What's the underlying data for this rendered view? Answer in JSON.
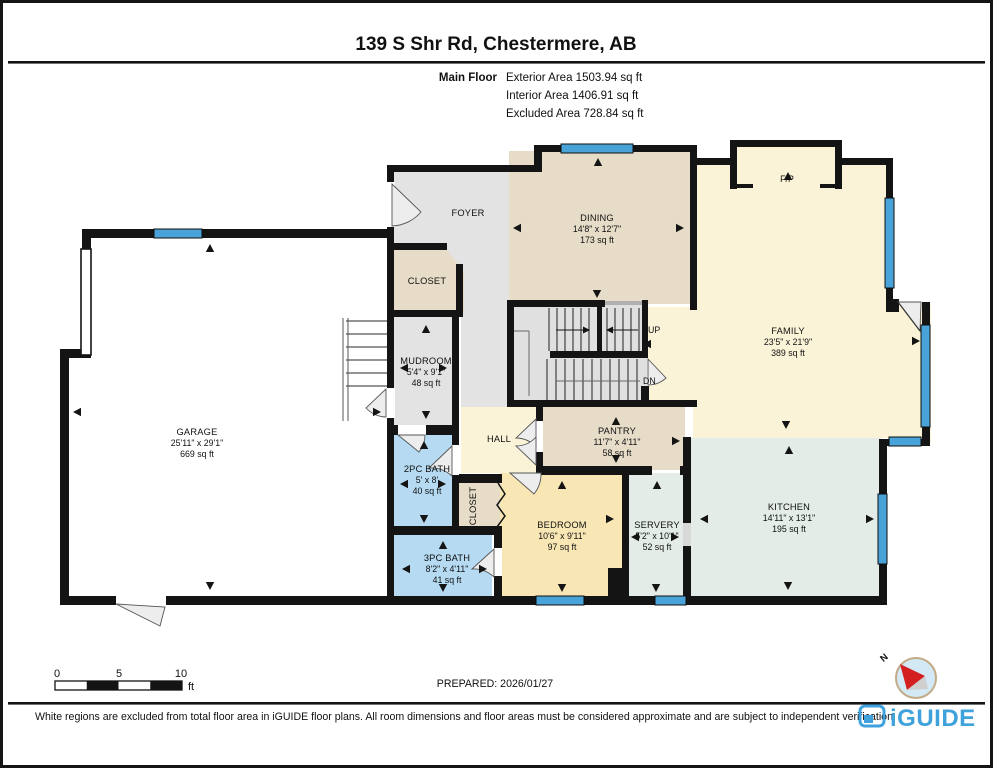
{
  "header": {
    "title": "139 S Shr Rd, Chestermere, AB",
    "floor_label": "Main Floor",
    "stats": [
      "Exterior Area 1503.94 sq ft",
      "Interior Area 1406.91 sq ft",
      "Excluded Area 728.84 sq ft"
    ]
  },
  "rooms": {
    "garage": {
      "name": "GARAGE",
      "dims": "25'11\" x 29'1\"",
      "area": "669 sq ft"
    },
    "foyer": {
      "name": "FOYER"
    },
    "closet_foyer": {
      "name": "CLOSET"
    },
    "dining": {
      "name": "DINING",
      "dims": "14'8\" x 12'7\"",
      "area": "173 sq ft"
    },
    "family": {
      "name": "FAMILY",
      "dims": "23'5\" x 21'9\"",
      "area": "389 sq ft"
    },
    "fireplace": {
      "name": "F/P"
    },
    "mudroom": {
      "name": "MUDROOM",
      "dims": "5'4\" x 9'1\"",
      "area": "48 sq ft"
    },
    "hall": {
      "name": "HALL"
    },
    "stairs_up": {
      "name": "UP"
    },
    "stairs_dn": {
      "name": "DN"
    },
    "pantry": {
      "name": "PANTRY",
      "dims": "11'7\" x 4'11\"",
      "area": "58 sq ft"
    },
    "bath2": {
      "name": "2PC BATH",
      "dims": "5' x 8'",
      "area": "40 sq ft"
    },
    "closet_bedroom": {
      "name": "CLOSET"
    },
    "bedroom": {
      "name": "BEDROOM",
      "dims": "10'6\" x 9'11\"",
      "area": "97 sq ft"
    },
    "bath3": {
      "name": "3PC BATH",
      "dims": "8'2\" x 4'11\"",
      "area": "41 sq ft"
    },
    "servery": {
      "name": "SERVERY",
      "dims": "5'2\" x 10'1\"",
      "area": "52 sq ft"
    },
    "kitchen": {
      "name": "KITCHEN",
      "dims": "14'11\" x 13'1\"",
      "area": "195 sq ft"
    }
  },
  "scale_bar": {
    "ticks": [
      "0",
      "5",
      "10"
    ],
    "unit": "ft"
  },
  "compass": {
    "north_label": "N"
  },
  "footer": {
    "prepared": "PREPARED: 2026/01/27",
    "disclaimer": "White regions are excluded from total floor area in iGUIDE floor plans. All room dimensions and floor areas must be considered approximate and are subject to independent verification.",
    "brand": "iGUIDE"
  },
  "colors": {
    "wall": "#141414",
    "window_blue": "#4aa3d8",
    "excluded_gray": "#e3e3e3",
    "tan": "#e6dcc8",
    "cream": "#fbf3d7",
    "wheat": "#f8e7b5",
    "bath_blue": "#b5daf2",
    "green": "#e3ece6",
    "brand_blue": "#3fa2dc",
    "compass_red": "#d31f1f"
  }
}
